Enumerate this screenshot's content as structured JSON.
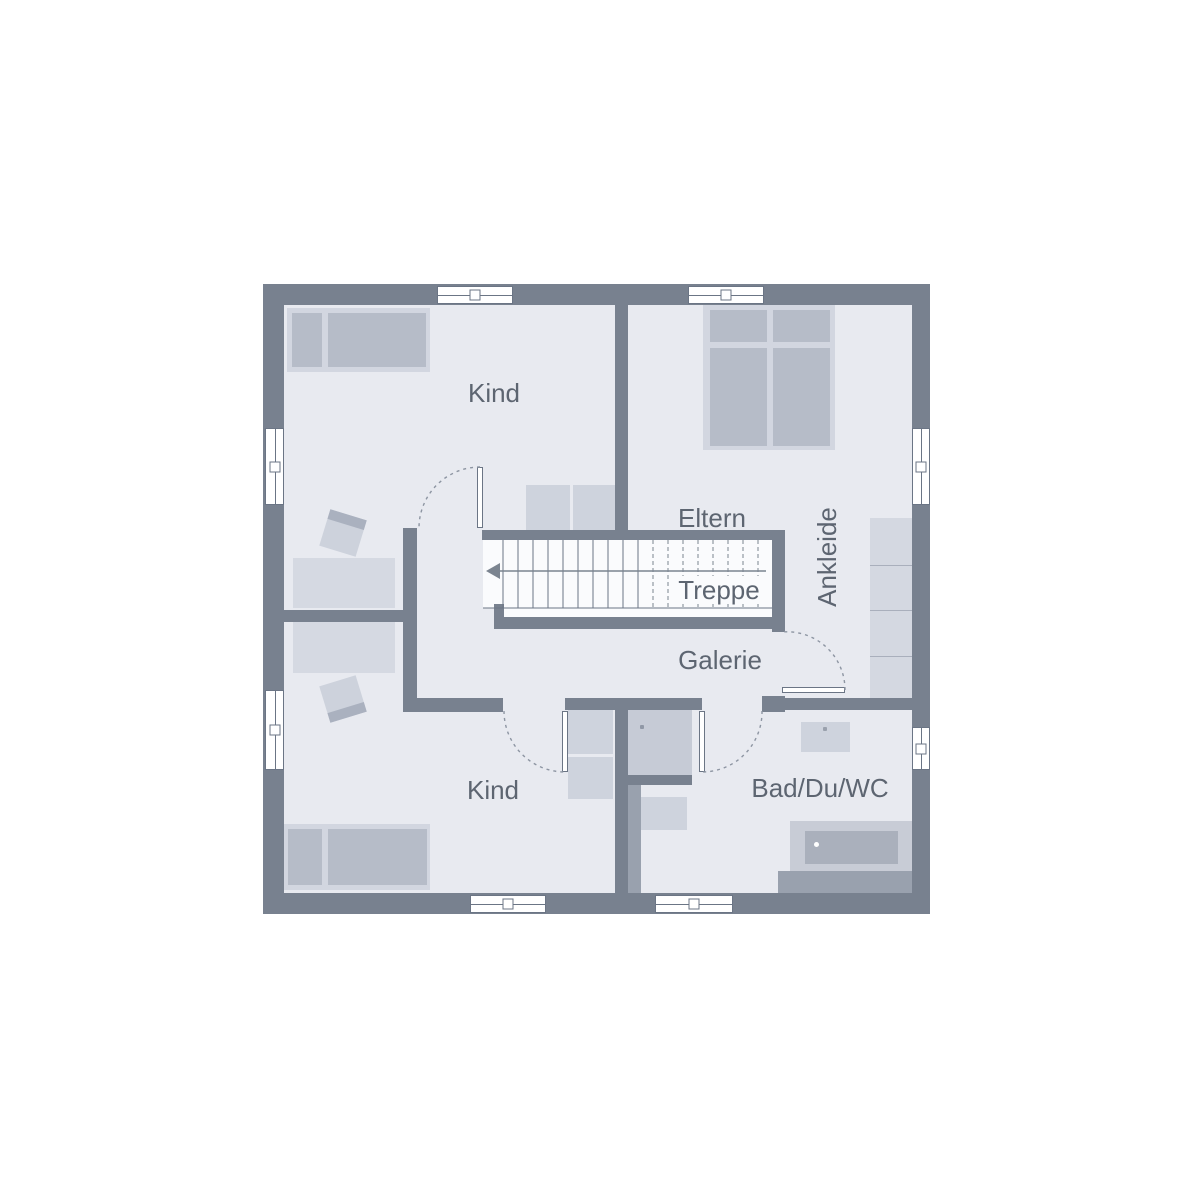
{
  "plan": {
    "rooms": [
      {
        "id": "kind-upper",
        "label": "Kind"
      },
      {
        "id": "eltern",
        "label": "Eltern"
      },
      {
        "id": "ankleide",
        "label": "Ankleide"
      },
      {
        "id": "treppe",
        "label": "Treppe"
      },
      {
        "id": "galerie",
        "label": "Galerie"
      },
      {
        "id": "kind-lower",
        "label": "Kind"
      },
      {
        "id": "bad",
        "label": "Bad/Du/WC"
      }
    ],
    "colors": {
      "wall": "#78818f",
      "floor": "#e8eaf0",
      "furniture_light": "#d2d6e0",
      "furniture_mid": "#b6bcc8",
      "cabinet": "#ced3dd",
      "tub_outer": "#c8ccd6",
      "tub_inner": "#aab0bc",
      "platform_gray": "#99a1ae",
      "label_text": "#5d6571",
      "line": "#6b7585",
      "door_arc": "#8d95a2"
    }
  }
}
